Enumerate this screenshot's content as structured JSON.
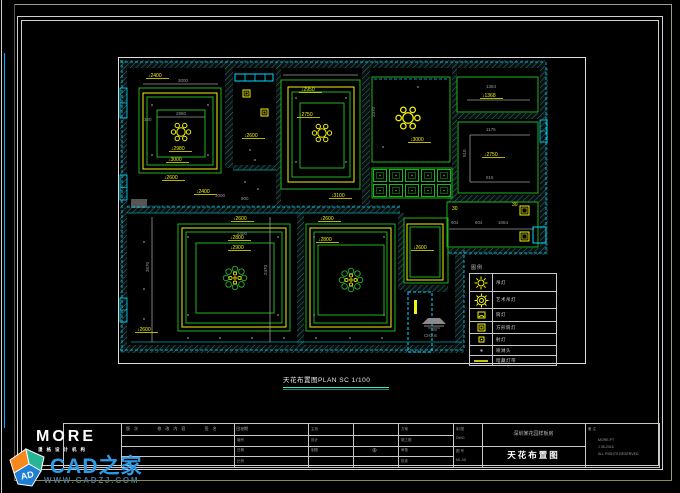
{
  "watermark": {
    "brand": "CAD之家",
    "url": "WWW.CADZJ.COM",
    "cube": "AD"
  },
  "logo": {
    "text": "MORE",
    "sub": "漫格设计机构"
  },
  "plan_title": {
    "text": "天花布置图PLAN  SC 1/100"
  },
  "ch_symbol": {
    "label": "CH2.6"
  },
  "legend": {
    "header": "图例",
    "rows": [
      {
        "label": "吊灯"
      },
      {
        "label": "艺术吊灯"
      },
      {
        "label": "筒灯"
      },
      {
        "label": "方形筒灯"
      },
      {
        "label": "射灯"
      },
      {
        "label": "喷淋头"
      },
      {
        "label": "暗藏灯带"
      }
    ]
  },
  "titleblock": {
    "rev_header": "版次   修改内容   签名   日期",
    "colC": [
      "工程",
      "编号",
      "日期",
      "比例"
    ],
    "colD": [
      "主持",
      "设计",
      "制图"
    ],
    "colE_sym": "⊕",
    "colF": [
      "方案",
      "施工图",
      "审核",
      "批准"
    ],
    "colG_top": [
      "制 图",
      "DWG"
    ],
    "colG_bottom": [
      "图 号",
      "ML-06"
    ],
    "project_name": "深圳某花园样板房",
    "drawing_name": "天花布置图",
    "remark_label": "备 注",
    "remarks": [
      "MORE-PT",
      "J 08-2016",
      "ALL RIGHTS RESERVED"
    ]
  },
  "plan": {
    "colors": {
      "G": "#1db51d",
      "Y": "#f2f20c",
      "C": "#00dcff",
      "T": "#00a8a8",
      "X": "#9a9a9a",
      "W": "#dddddd",
      "F": "#555555"
    },
    "hatches": [
      [
        2,
        3,
        425,
        8
      ],
      [
        2,
        3,
        7,
        292
      ],
      [
        2,
        288,
        344,
        8
      ],
      [
        422,
        11,
        8,
        182
      ],
      [
        337,
        195,
        9,
        93
      ],
      [
        329,
        191,
        101,
        7
      ],
      [
        107,
        3,
        8,
        108
      ],
      [
        158,
        3,
        5,
        145
      ],
      [
        244,
        3,
        8,
        145
      ],
      [
        334,
        3,
        5,
        141
      ],
      [
        9,
        148,
        273,
        8
      ],
      [
        115,
        108,
        43,
        5
      ],
      [
        337,
        56,
        93,
        6
      ],
      [
        330,
        138,
        100,
        7
      ],
      [
        179,
        156,
        7,
        132
      ],
      [
        280,
        156,
        6,
        77
      ],
      [
        286,
        228,
        44,
        7
      ]
    ],
    "rects": [
      [
        0.5,
        0.5,
        467,
        306,
        "W",
        0
      ],
      [
        21,
        31,
        82,
        85,
        "G",
        0
      ],
      [
        25,
        36,
        74,
        76,
        "Y",
        0
      ],
      [
        29,
        40,
        66,
        68,
        "G",
        0
      ],
      [
        39,
        53,
        48,
        47,
        "G",
        0
      ],
      [
        163,
        23,
        79,
        109,
        "G",
        0
      ],
      [
        170,
        30,
        66,
        95,
        "Y",
        0
      ],
      [
        174,
        35,
        58,
        85,
        "G",
        0
      ],
      [
        182,
        46,
        44,
        65,
        "G",
        0
      ],
      [
        254,
        20,
        78,
        85,
        "G",
        0
      ],
      [
        339,
        20,
        81,
        35,
        "G",
        0
      ],
      [
        340,
        65,
        80,
        71,
        "G",
        0
      ],
      [
        329,
        145,
        91,
        45,
        "G",
        0
      ],
      [
        286,
        161,
        44,
        65,
        "G",
        0
      ],
      [
        289,
        167,
        36,
        56,
        "Y",
        0
      ],
      [
        292,
        170,
        30,
        50,
        "G",
        0
      ],
      [
        60,
        167,
        112,
        107,
        "G",
        0
      ],
      [
        64,
        171,
        104,
        99,
        "Y",
        0
      ],
      [
        68,
        175,
        96,
        91,
        "G",
        0
      ],
      [
        78,
        186,
        78,
        70,
        "G",
        0
      ],
      [
        188,
        167,
        89,
        107,
        "G",
        0
      ],
      [
        192,
        171,
        81,
        99,
        "Y",
        0
      ],
      [
        196,
        175,
        73,
        91,
        "G",
        0
      ],
      [
        200,
        188,
        66,
        70,
        "G",
        0
      ],
      [
        254,
        111,
        80,
        30,
        "G",
        0
      ],
      [
        290,
        235,
        24,
        60,
        "C",
        1
      ],
      [
        117,
        17,
        38,
        7,
        "C",
        0
      ],
      [
        415,
        170,
        13,
        16,
        "C",
        0
      ],
      [
        13,
        142,
        16,
        9,
        "F",
        0
      ],
      [
        296,
        243,
        3,
        14,
        "YF",
        0
      ]
    ],
    "windows": [
      [
        2,
        31,
        7,
        30
      ],
      [
        2,
        118,
        7,
        25
      ],
      [
        2,
        241,
        7,
        24
      ],
      [
        422,
        63,
        7,
        22
      ]
    ],
    "lines": [
      [
        2,
        5,
        427,
        5,
        "C",
        1
      ],
      [
        4,
        3,
        4,
        295,
        "C",
        1
      ],
      [
        2,
        293,
        346,
        293,
        "C",
        1
      ],
      [
        428,
        5,
        428,
        193,
        "C",
        1
      ],
      [
        346,
        193,
        346,
        293,
        "C",
        1
      ],
      [
        331,
        196,
        430,
        196,
        "C",
        1
      ],
      [
        9,
        150,
        282,
        150,
        "C",
        1
      ],
      [
        256,
        22,
        330,
        22,
        "C",
        1
      ],
      [
        13,
        285,
        344,
        285,
        "T",
        0
      ],
      [
        9,
        156,
        282,
        156,
        "T",
        0
      ],
      [
        115,
        113,
        158,
        113,
        "T",
        0
      ],
      [
        25,
        27,
        100,
        27,
        "X",
        0
      ],
      [
        39,
        60,
        87,
        60,
        "X",
        0
      ],
      [
        349,
        43,
        412,
        43,
        "X",
        0
      ],
      [
        352,
        78,
        412,
        78,
        "X",
        0
      ],
      [
        352,
        125,
        412,
        125,
        "X",
        0
      ],
      [
        352,
        78,
        352,
        125,
        "X",
        0
      ],
      [
        331,
        172,
        416,
        172,
        "X",
        0
      ],
      [
        34,
        160,
        34,
        285,
        "X",
        0
      ],
      [
        152,
        160,
        152,
        285,
        "X",
        0
      ],
      [
        165,
        18,
        240,
        18,
        "X",
        0
      ],
      [
        127,
        17,
        127,
        24,
        "C",
        0
      ],
      [
        137,
        17,
        137,
        24,
        "C",
        0
      ],
      [
        147,
        17,
        147,
        24,
        "C",
        0
      ]
    ],
    "labels": [
      [
        30,
        20,
        "↓2400",
        "Y",
        1
      ],
      [
        60,
        25,
        "3000",
        "X",
        0
      ],
      [
        58,
        58,
        "2980",
        "X",
        0
      ],
      [
        26,
        64,
        "320",
        "X",
        0
      ],
      [
        53,
        93,
        "↓2980",
        "Y",
        1
      ],
      [
        50,
        104,
        "↓3000",
        "Y",
        1
      ],
      [
        46,
        122,
        "↓2600",
        "Y",
        1
      ],
      [
        78,
        136,
        "↓2400",
        "Y",
        1
      ],
      [
        97,
        140,
        "3000",
        "X",
        0
      ],
      [
        126,
        80,
        "↓2600",
        "Y",
        1
      ],
      [
        123,
        143,
        "900",
        "X",
        0
      ],
      [
        183,
        34,
        "↓2950",
        "Y",
        1
      ],
      [
        181,
        59,
        "↓2750",
        "Y",
        1
      ],
      [
        213,
        140,
        "↓3100",
        "Y",
        1
      ],
      [
        292,
        84,
        "↓3000",
        "Y",
        1
      ],
      [
        368,
        31,
        "1364",
        "X",
        0
      ],
      [
        364,
        40,
        "↓1368",
        "Y",
        1
      ],
      [
        368,
        74,
        "1175",
        "X",
        0
      ],
      [
        366,
        99,
        "↓2750",
        "Y",
        1
      ],
      [
        368,
        122,
        "915",
        "X",
        0
      ],
      [
        333,
        167,
        "904",
        "X",
        0
      ],
      [
        357,
        167,
        "604",
        "X",
        0
      ],
      [
        380,
        167,
        "1064",
        "X",
        0
      ],
      [
        334,
        153,
        "30",
        "Y",
        0
      ],
      [
        394,
        149,
        "30",
        "Y",
        0
      ],
      [
        115,
        163,
        "↓2600",
        "Y",
        1
      ],
      [
        112,
        182,
        "↓2800",
        "Y",
        1
      ],
      [
        112,
        192,
        "↓2900",
        "Y",
        1
      ],
      [
        202,
        163,
        "↓2600",
        "Y",
        1
      ],
      [
        200,
        184,
        "↓2800",
        "Y",
        1
      ],
      [
        295,
        192,
        "↓2600",
        "Y",
        1
      ],
      [
        19,
        274,
        "↓2600",
        "Y",
        1
      ],
      [
        119,
        178,
        "2400",
        "X",
        0
      ]
    ],
    "vlabels": [
      [
        31,
        215,
        "3670"
      ],
      [
        149,
        218,
        "2470"
      ],
      [
        257,
        60,
        "2470"
      ],
      [
        348,
        100,
        "910"
      ]
    ],
    "dots": [
      [
        34,
        48
      ],
      [
        90,
        48
      ],
      [
        34,
        98
      ],
      [
        90,
        98
      ],
      [
        132,
        93
      ],
      [
        137,
        103
      ],
      [
        127,
        125
      ],
      [
        140,
        132
      ],
      [
        178,
        41
      ],
      [
        228,
        41
      ],
      [
        178,
        105
      ],
      [
        228,
        105
      ],
      [
        265,
        90
      ],
      [
        300,
        30
      ],
      [
        70,
        180
      ],
      [
        160,
        180
      ],
      [
        70,
        258
      ],
      [
        160,
        258
      ],
      [
        196,
        180
      ],
      [
        266,
        180
      ],
      [
        196,
        258
      ],
      [
        266,
        258
      ],
      [
        70,
        281
      ],
      [
        102,
        281
      ],
      [
        134,
        281
      ],
      [
        166,
        281
      ],
      [
        198,
        281
      ],
      [
        232,
        281
      ],
      [
        264,
        281
      ],
      [
        26,
        185
      ],
      [
        26,
        232
      ],
      [
        26,
        262
      ]
    ],
    "lampsq": [
      [
        125,
        33,
        7
      ],
      [
        143,
        52,
        7
      ],
      [
        402,
        149,
        9
      ],
      [
        402,
        175,
        9
      ]
    ],
    "ch6": [
      [
        63,
        75,
        1
      ],
      [
        204,
        76,
        1
      ],
      [
        290,
        61,
        1.25
      ]
    ],
    "flowers": [
      [
        117,
        221
      ],
      [
        233,
        223
      ]
    ],
    "coffer": {
      "x": 254,
      "y": 111,
      "cols": 5,
      "rows": 2,
      "cw": 16,
      "ch": 15
    }
  }
}
